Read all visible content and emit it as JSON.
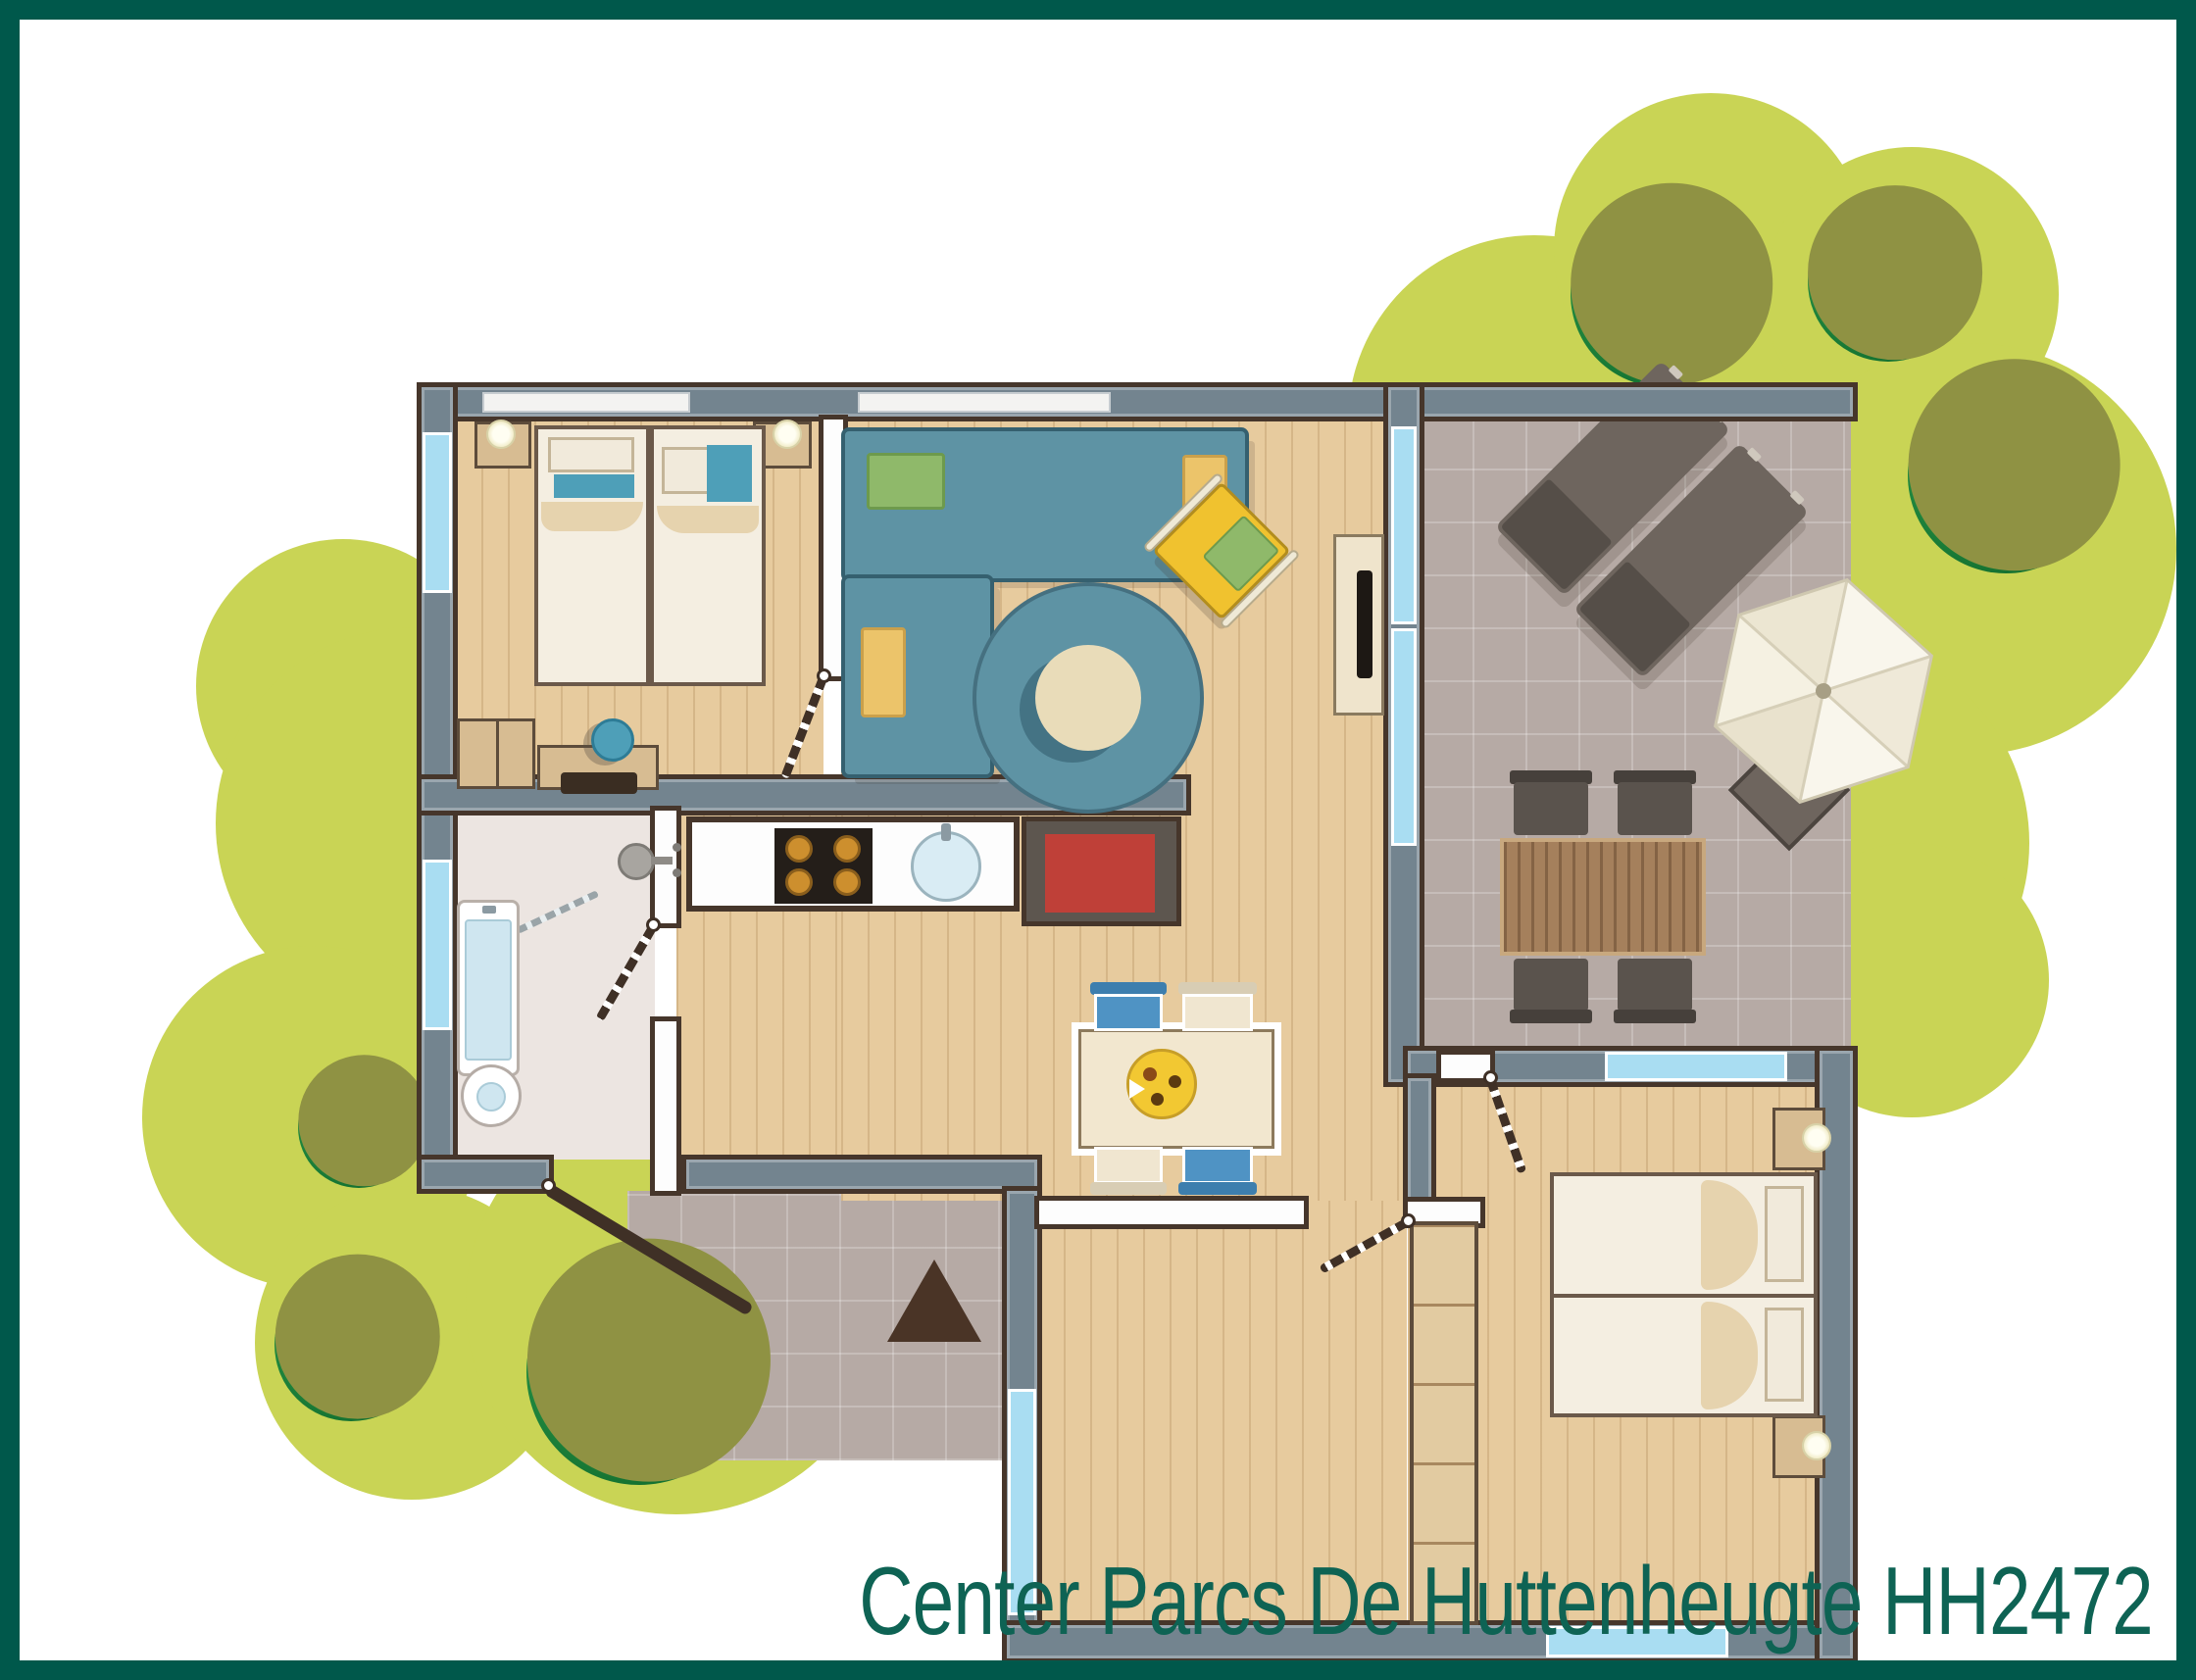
{
  "caption": {
    "text": "Center Parcs De Huttenheugte HH2472"
  },
  "colors": {
    "frame": "#00584b",
    "caption": "#0e6354",
    "blob": "#c9d455",
    "bush": "#157231",
    "bush-light": "#2a9a4a",
    "bush-olive": "#8f9243",
    "tile": "#b6aaa5",
    "wood": "#e7cb9e",
    "bath-floor": "#ece5e1",
    "wall": "#73848f",
    "wall-dark": "#46362b",
    "window": "#a9ddf2",
    "door": "#3f3026",
    "sofa": "#5e93a4",
    "sofa-dark": "#35606f",
    "rug-center": "#e9dcb9",
    "armchair": "#f0c22f",
    "cushion-green": "#8fb96a",
    "cushion-sand": "#ecc46a",
    "bed": "#f4eee1",
    "bed-shade": "#e6d3ae",
    "blanket": "#4e9fb8",
    "nightstand": "#d7bc92",
    "stove": "#241e19",
    "burner": "#cd8f2e",
    "sink": "#d9ecf4",
    "fire-red": "#bf4038",
    "fire-gray": "#5d564f",
    "table-cream": "#f2e7cf",
    "pizza": "#f2c832",
    "lounger": "#6e655e",
    "lounger-dark": "#554e48",
    "umbrella": "#f8f5ea",
    "chair-blue": "#4f93c4",
    "chair-cream": "#f0e6d0",
    "wardrobe": "#e2cba1"
  },
  "plan": {
    "rooms": [
      "garden",
      "terrace",
      "living-room",
      "bedroom-1",
      "bathroom",
      "kitchen",
      "dining-area",
      "hallway",
      "bedroom-2",
      "entrance-porch"
    ],
    "furniture": [
      "twin-beds",
      "nightstands-with-lamps",
      "corner-sofa",
      "round-rug",
      "armchair",
      "tv-cabinet",
      "kitchen-counter",
      "stove",
      "sink",
      "fireplace",
      "dining-table-with-pizza",
      "chairs",
      "bathtub",
      "toilet",
      "shower",
      "wardrobe",
      "sun-loungers",
      "parasol",
      "garden-table",
      "entrance-arrow"
    ]
  }
}
